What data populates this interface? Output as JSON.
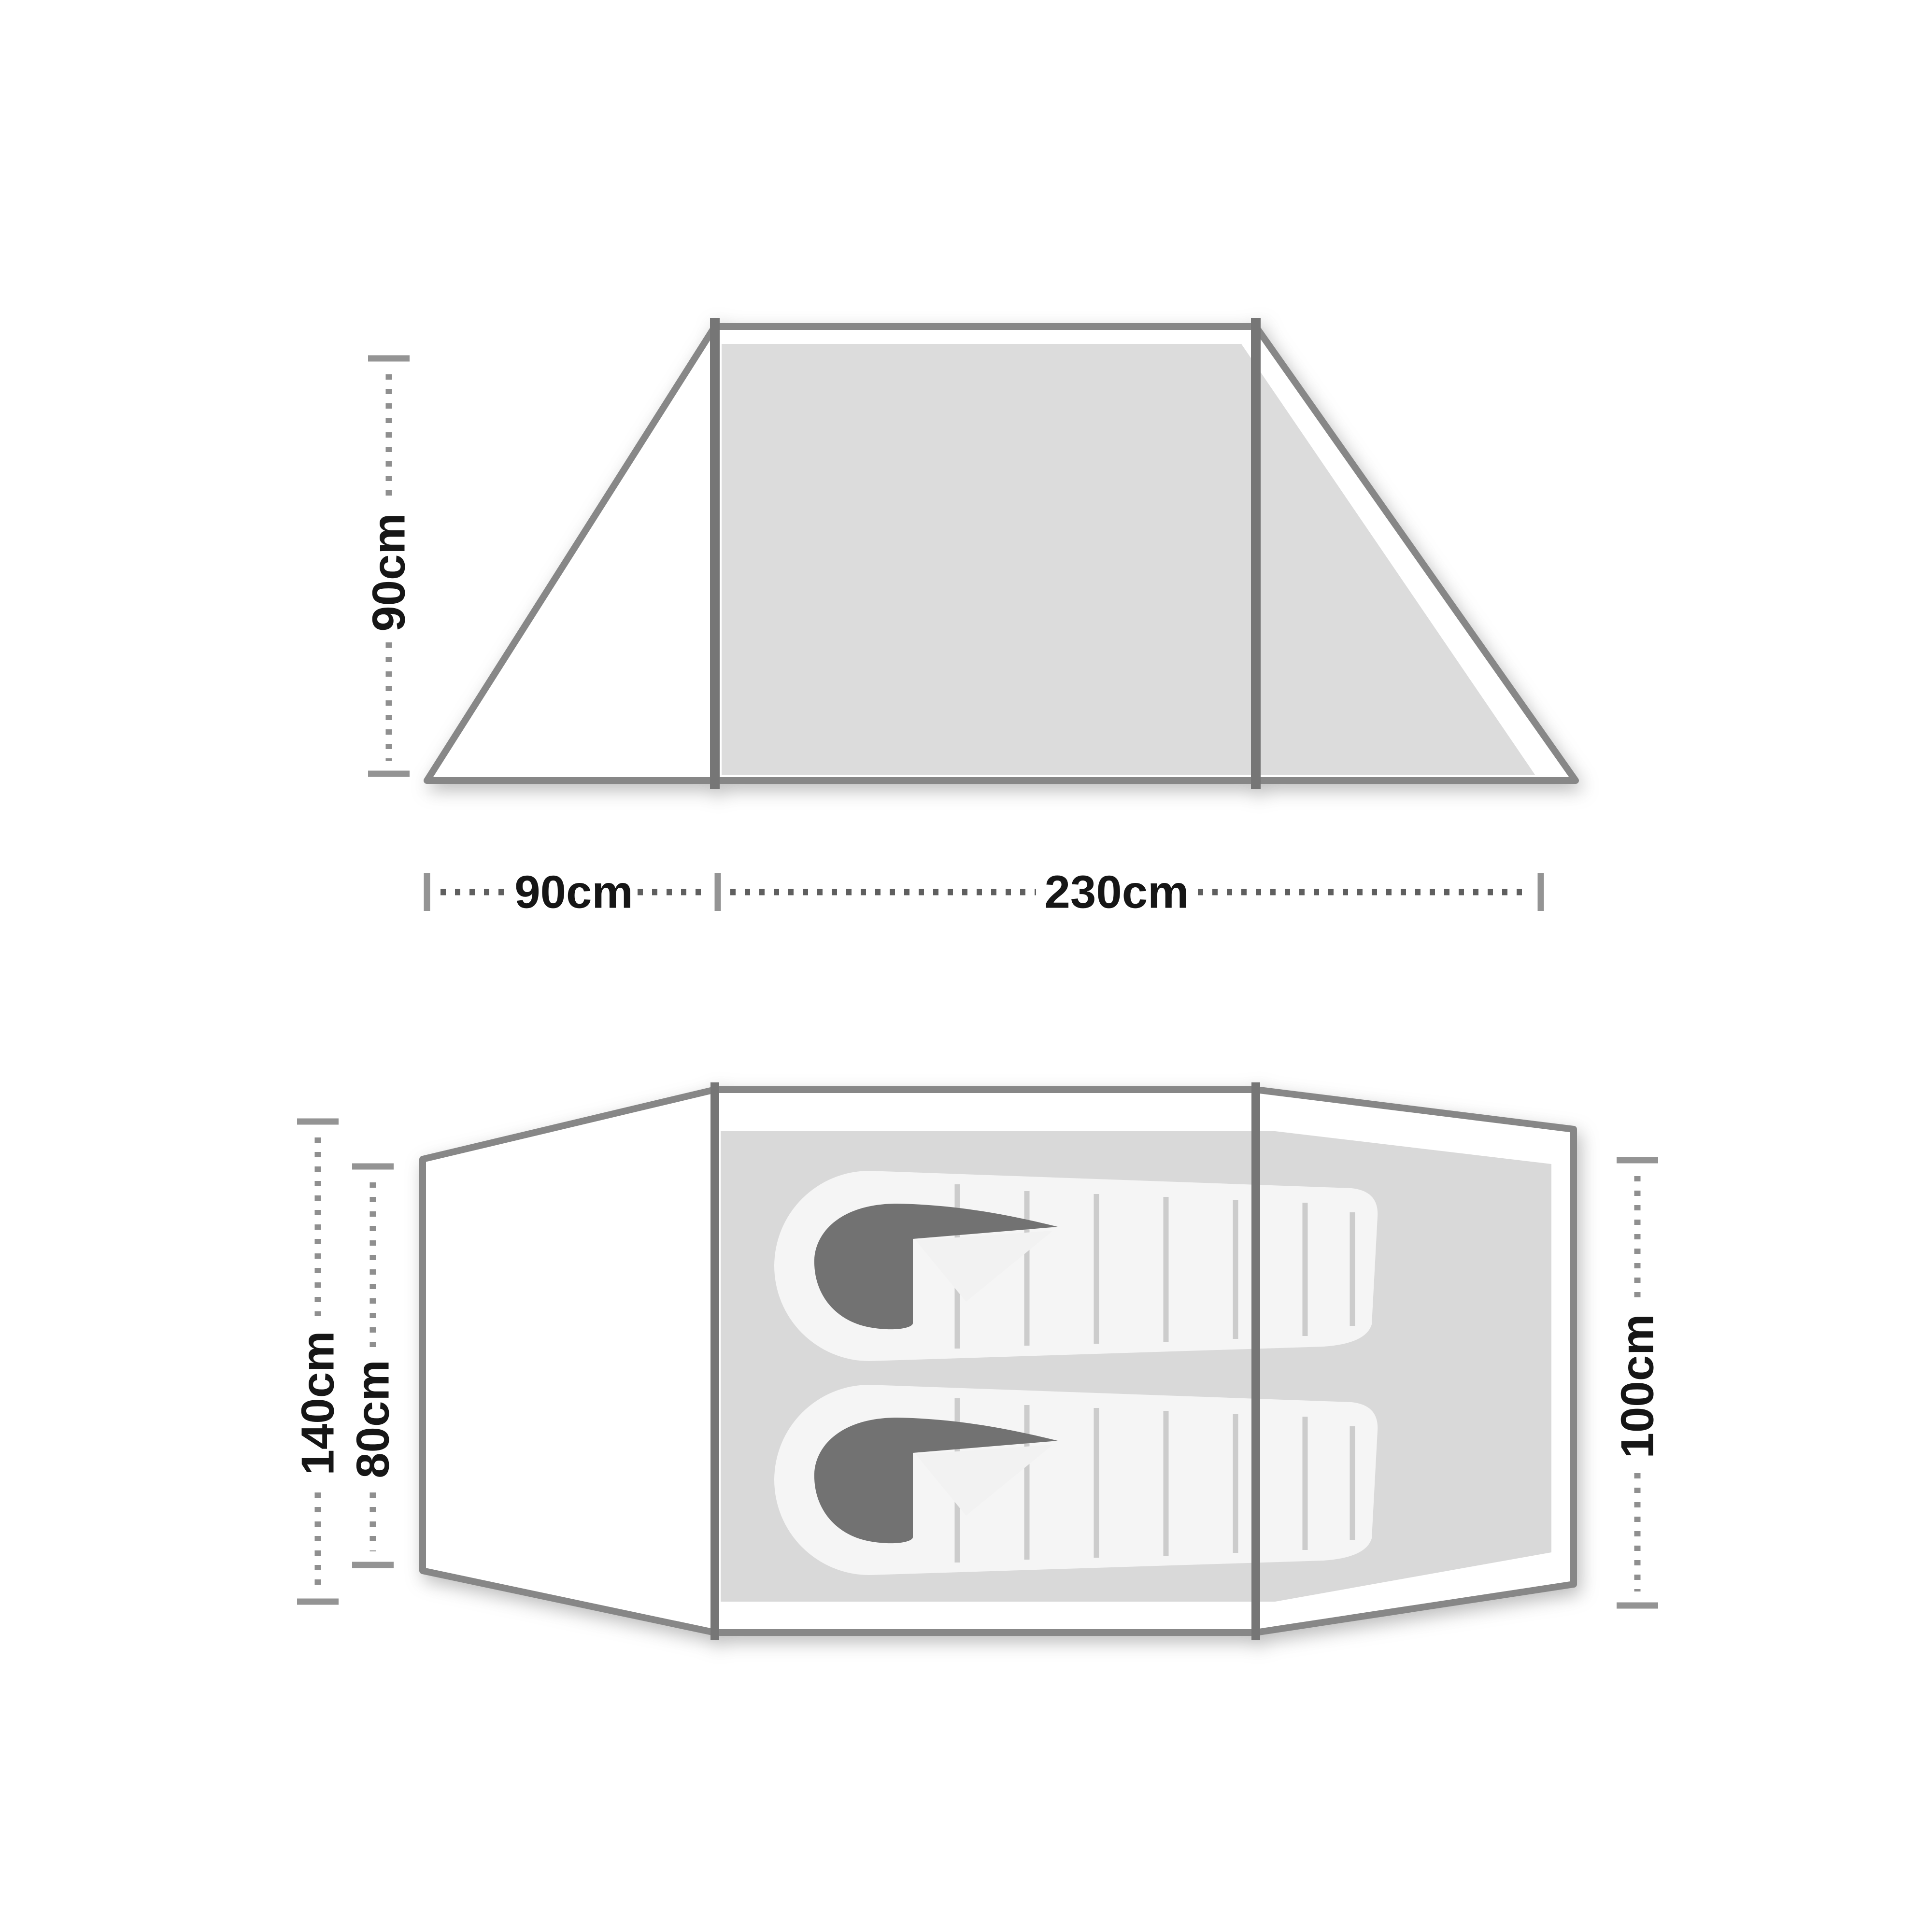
{
  "side_view": {
    "height_label": "90cm",
    "porch_width_label": "90cm",
    "inner_length_label": "230cm"
  },
  "top_view": {
    "overall_width_label": "140cm",
    "porch_depth_label": "80cm",
    "inner_width_label": "100cm",
    "sleeping_bag_count": 2
  },
  "colors": {
    "outline": "#878787",
    "pole": "#767676",
    "panel_fill": "#dcdcdc",
    "groundsheet_fill": "#d9d9d9",
    "sleeping_bag_fill": "#f5f5f5",
    "sleeping_bag_baffle": "#cccccc",
    "hood": "#727272",
    "dimension_text": "#161616",
    "dimension_marks": "#949494"
  }
}
